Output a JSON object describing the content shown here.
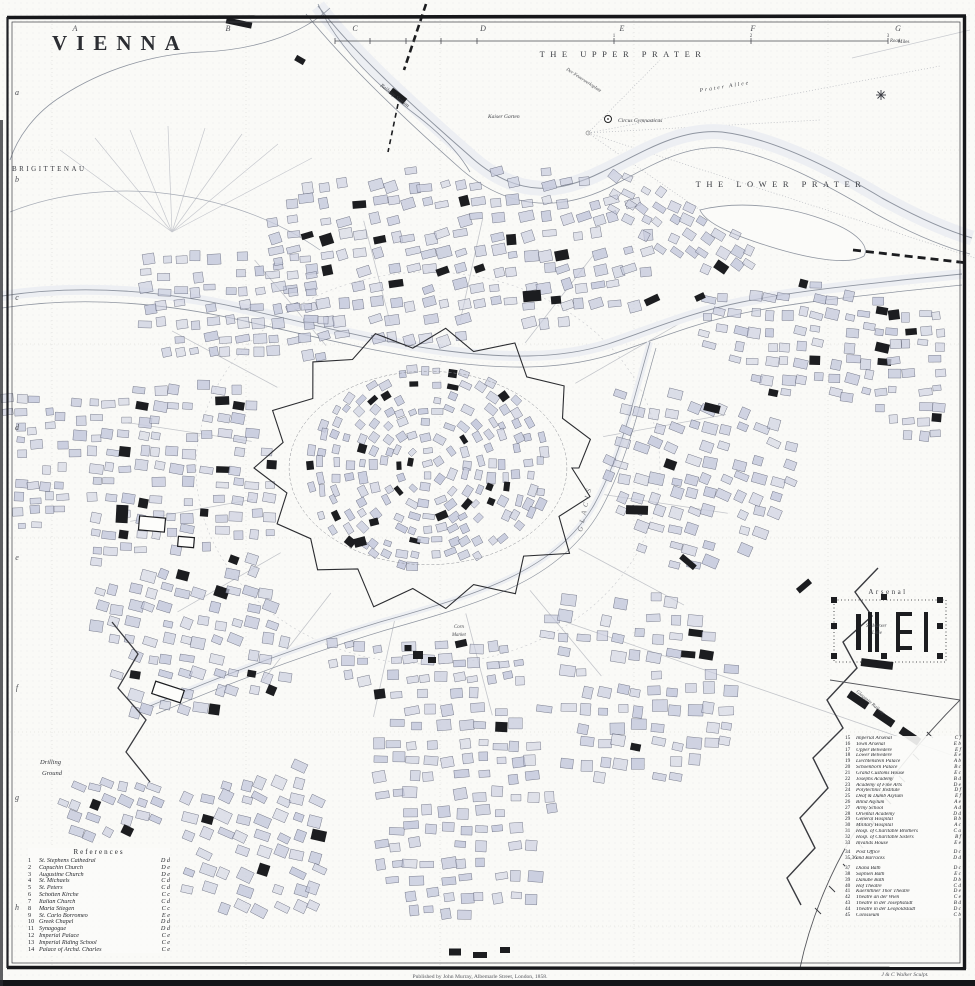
{
  "labels": {
    "title": "VIENNA",
    "upper_prater": "THE UPPER PRATER",
    "lower_prater": "THE LOWER PRATER",
    "brigittenau": "BRIGITTENAU",
    "drilling_1": "Drilling",
    "drilling_2": "Ground",
    "glacis": "GLACIS",
    "kaiser_garten": "Kaiser Garten",
    "circus": "Circus Gymnasticus",
    "arsenal": "Arsenal",
    "railway_station": "Railway Station",
    "feuerwerksplatz": "Der Feuerwerksplatz",
    "prater_allee": "Prater Allee",
    "road": "Road",
    "corn_1": "Corn",
    "corn_2": "Market",
    "linie_1": "St. Marxer",
    "linie_2": "Linie",
    "gloggnitz": "Gloggnitz Railway",
    "scale_1": "1",
    "scale_2": "2",
    "scale_3": "3",
    "scale_unit": "Miles",
    "imprint": "Published by John Murray, Albemarle Street, London, 1858.",
    "engraver": "J & C Walker Sculpt."
  },
  "grid": {
    "top": [
      "A",
      "B",
      "C",
      "D",
      "E",
      "F",
      "G"
    ],
    "left": [
      "a",
      "b",
      "c",
      "d",
      "e",
      "f",
      "g",
      "h"
    ]
  },
  "references_left": {
    "title": "References",
    "items": [
      {
        "n": "1",
        "name": "St. Stephens Cathedral",
        "ref": "D d"
      },
      {
        "n": "2",
        "name": "Capuchin Church",
        "ref": "D e"
      },
      {
        "n": "3",
        "name": "Augustine Church",
        "ref": "D e"
      },
      {
        "n": "4",
        "name": "St. Michaels",
        "ref": "C d"
      },
      {
        "n": "5",
        "name": "St. Peters",
        "ref": "C d"
      },
      {
        "n": "6",
        "name": "Schotten Kirche",
        "ref": "C c"
      },
      {
        "n": "7",
        "name": "Italian Church",
        "ref": "C d"
      },
      {
        "n": "8",
        "name": "Maria Stiegen",
        "ref": "C c"
      },
      {
        "n": "9",
        "name": "St. Carlo Borromeo",
        "ref": "E e"
      },
      {
        "n": "10",
        "name": "Greek Chapel",
        "ref": "D d"
      },
      {
        "n": "11",
        "name": "Synagogue",
        "ref": "D d"
      },
      {
        "n": "12",
        "name": "Imperial Palace",
        "ref": "C e"
      },
      {
        "n": "13",
        "name": "Imperial Riding School",
        "ref": "C e"
      },
      {
        "n": "14",
        "name": "Palace of Archd. Charles",
        "ref": "C e"
      }
    ]
  },
  "references_right": {
    "items": [
      {
        "n": "15",
        "name": "Imperial Arsenal",
        "ref": "C f"
      },
      {
        "n": "16",
        "name": "Town Arsenal",
        "ref": "E b"
      },
      {
        "n": "17",
        "name": "Upper Belvedere",
        "ref": "E f"
      },
      {
        "n": "18",
        "name": "Lower Belvedere",
        "ref": "E e"
      },
      {
        "n": "19",
        "name": "Liechtenstein Palace",
        "ref": "A b"
      },
      {
        "n": "20",
        "name": "Schoenborn Palace",
        "ref": "B c"
      },
      {
        "n": "21",
        "name": "Grand Customs House",
        "ref": "E c"
      },
      {
        "n": "22",
        "name": "Josephs Academy",
        "ref": "B d"
      },
      {
        "n": "23",
        "name": "Academy of Fine Arts",
        "ref": "D e"
      },
      {
        "n": "24",
        "name": "Polytechnic Institute",
        "ref": "D f"
      },
      {
        "n": "25",
        "name": "Deaf & Dumb Asylum",
        "ref": "E f"
      },
      {
        "n": "26",
        "name": "Blind Asylum",
        "ref": "A e"
      },
      {
        "n": "27",
        "name": "Army School",
        "ref": "A d"
      },
      {
        "n": "28",
        "name": "Oriental Academy",
        "ref": "D d"
      },
      {
        "n": "29",
        "name": "General Hospital",
        "ref": "B b"
      },
      {
        "n": "30",
        "name": "Military Hospital",
        "ref": "A c"
      },
      {
        "n": "31",
        "name": "Hosp. of Charitable Brothers",
        "ref": "C a"
      },
      {
        "n": "32",
        "name": "Hosp. of Charitable Sisters",
        "ref": "B f"
      },
      {
        "n": "33",
        "name": "Invalids House",
        "ref": "E e"
      },
      {
        "n": "34",
        "name": "Post Office",
        "ref": "D c",
        "gap": true
      },
      {
        "n": "35,36",
        "name": "and Barracks",
        "ref": "D d"
      },
      {
        "n": "37",
        "name": "Diana Bath",
        "ref": "D c",
        "gap": true
      },
      {
        "n": "38",
        "name": "Sophien Bath",
        "ref": "E c"
      },
      {
        "n": "39",
        "name": "Danube Bath",
        "ref": "D b"
      },
      {
        "n": "40",
        "name": "Hof Theatre",
        "ref": "C d"
      },
      {
        "n": "41",
        "name": "Kaernthner Thor Theatre",
        "ref": "D e"
      },
      {
        "n": "42",
        "name": "Theatre an der Wien",
        "ref": "C e"
      },
      {
        "n": "43",
        "name": "Theatre in der Josephstadt",
        "ref": "B d"
      },
      {
        "n": "44",
        "name": "Theatre in der Leopoldstadt",
        "ref": "D c"
      },
      {
        "n": "45",
        "name": "Colosseum",
        "ref": "C b"
      }
    ]
  },
  "colors": {
    "block": "#c8ccde",
    "block_stroke": "#52566a",
    "ink": "#1c1d20",
    "water_line": "#8f95a0",
    "water_tint": "#edeff3",
    "faint": "#c6c8ce"
  }
}
